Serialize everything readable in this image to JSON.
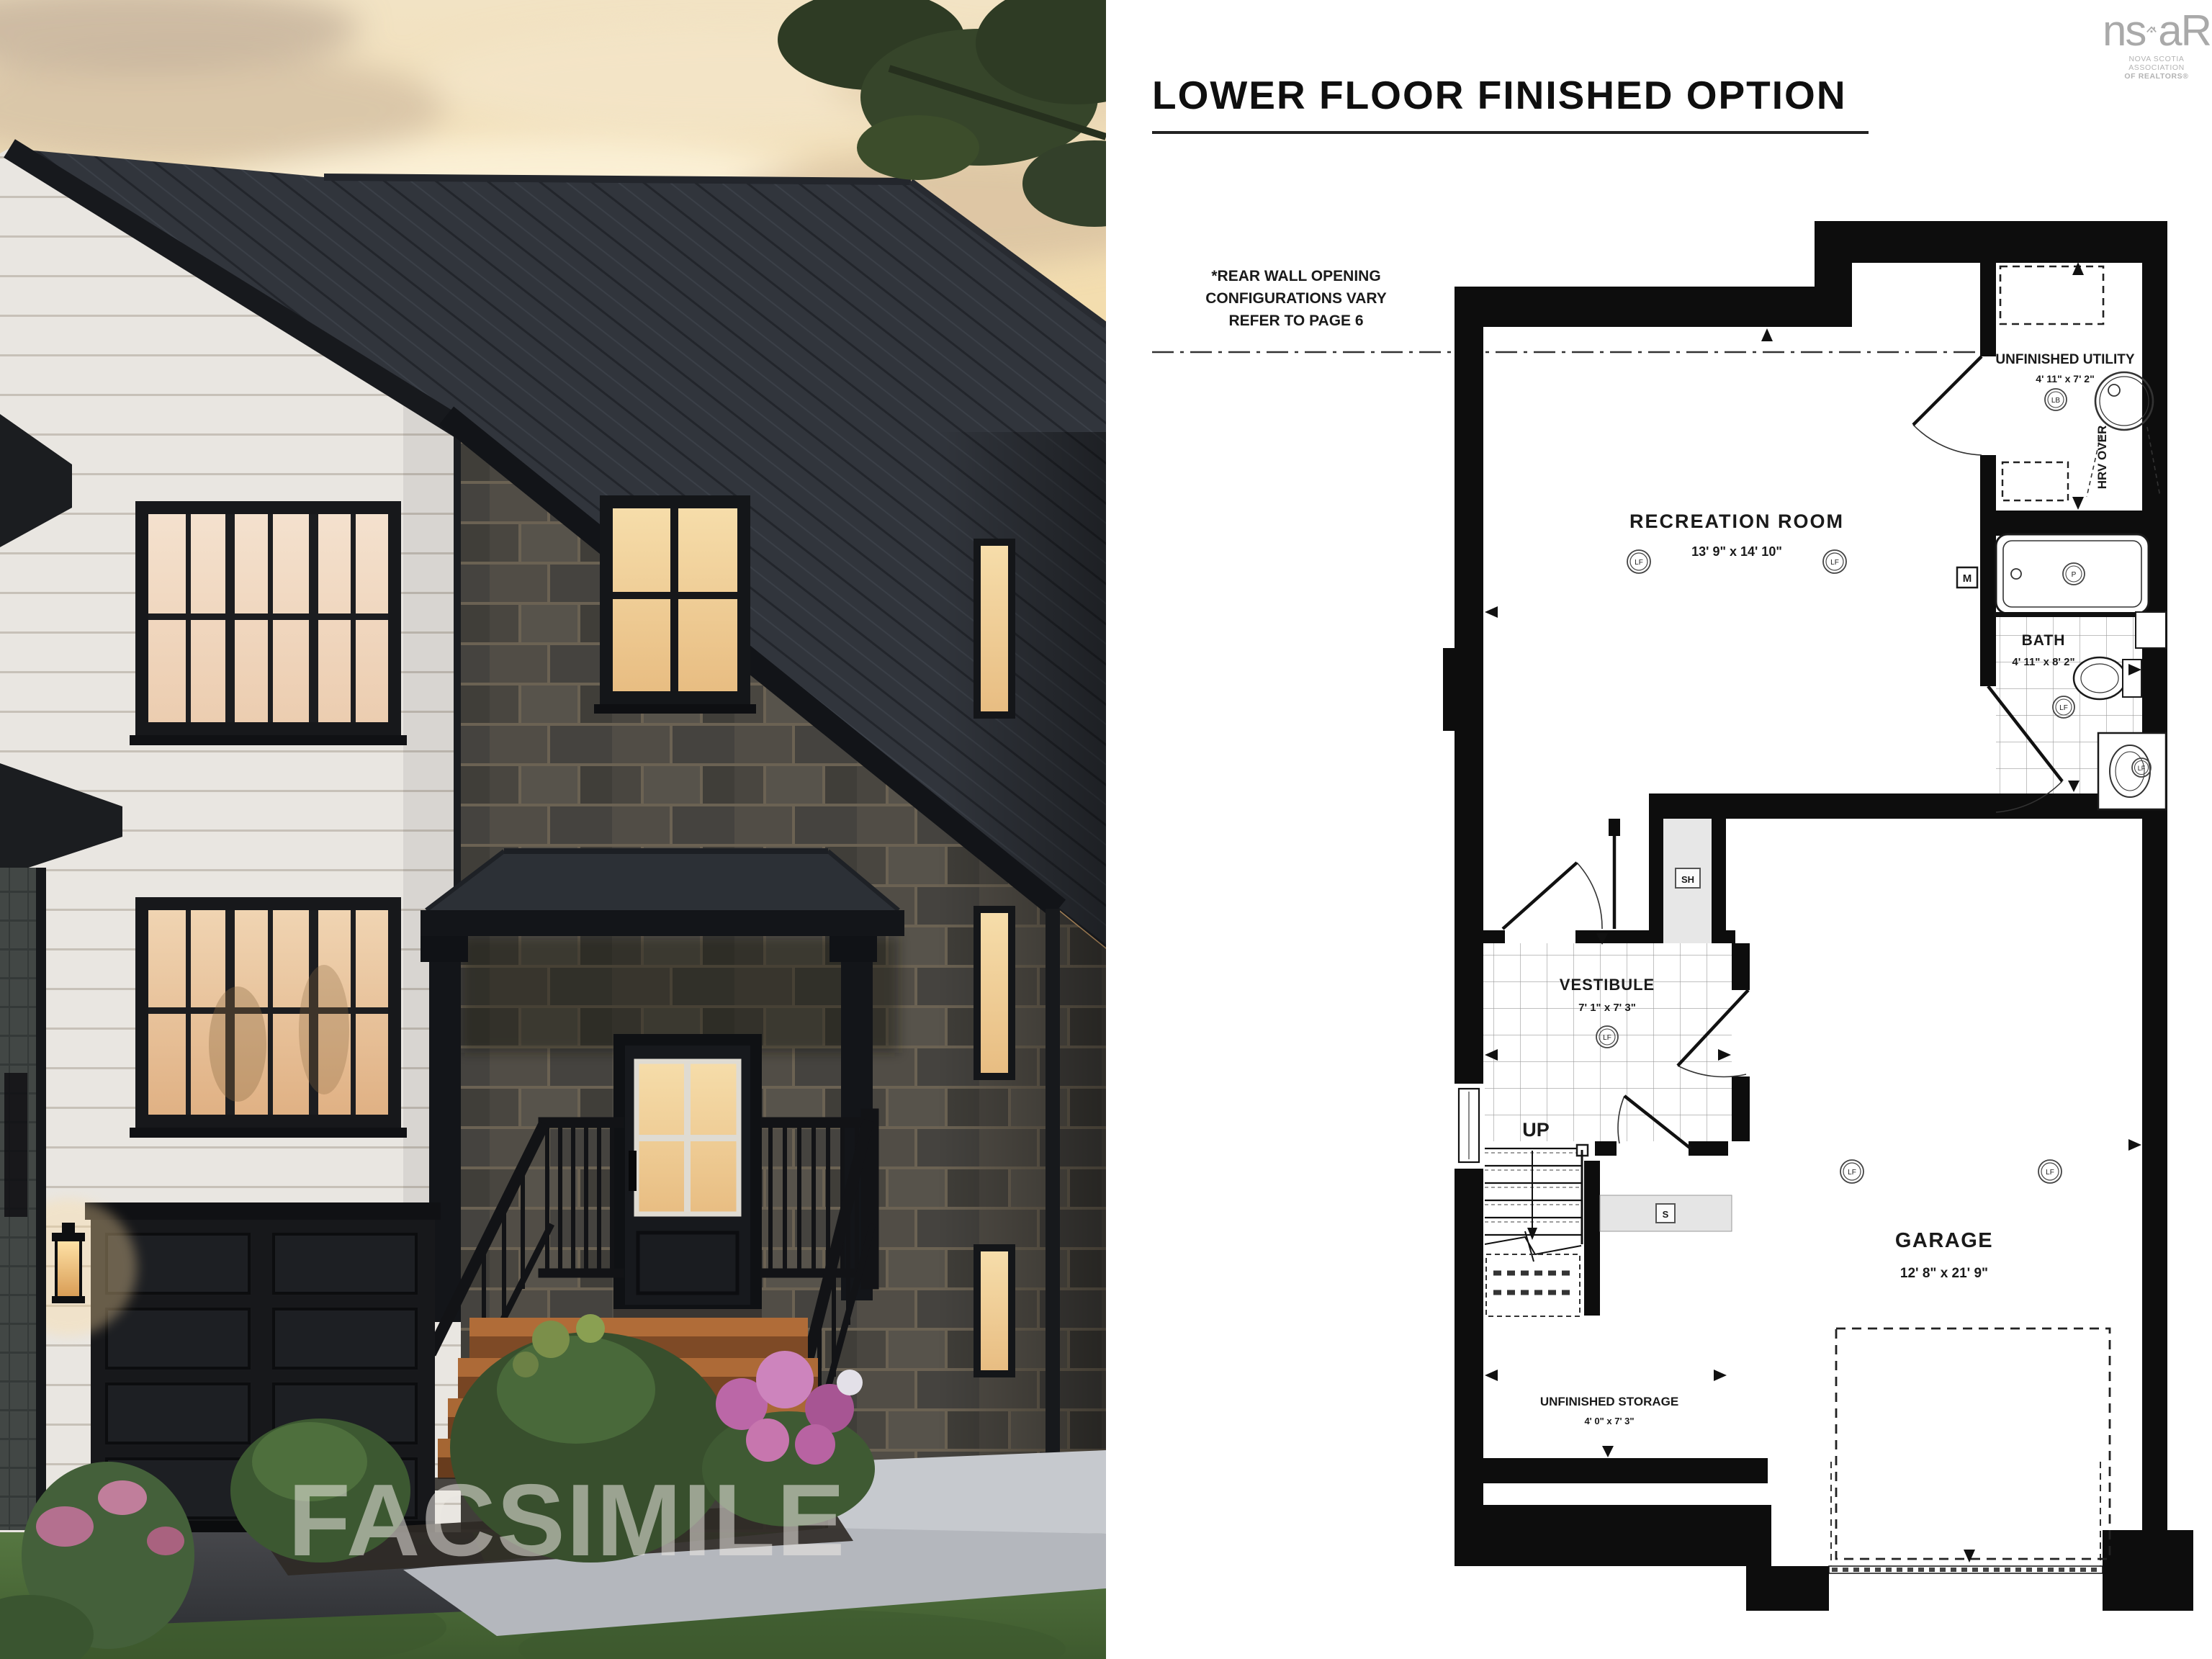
{
  "left_panel": {
    "watermark": "FACSIMILE"
  },
  "right_panel": {
    "title": "LOWER FLOOR FINISHED OPTION",
    "note": {
      "line1": "*REAR WALL OPENING",
      "line2": "CONFIGURATIONS VARY",
      "line3": "REFER TO PAGE 6"
    },
    "logo": {
      "prefix": "ns",
      "suffix": "aR",
      "line1": "NOVA SCOTIA ASSOCIATION",
      "line2": "OF REALTORS®"
    },
    "rooms": {
      "recreation": {
        "name": "RECREATION ROOM",
        "dims": "13' 9\" x 14' 10\""
      },
      "utility": {
        "name": "UNFINISHED UTILITY",
        "dims": "4' 11\" x 7' 2\""
      },
      "bath": {
        "name": "BATH",
        "dims": "4' 11\" x 8' 2\""
      },
      "vestibule": {
        "name": "VESTIBULE",
        "dims": "7' 1\" x 7' 3\""
      },
      "garage": {
        "name": "GARAGE",
        "dims": "12' 8\" x 21' 9\""
      },
      "storage": {
        "name": "UNFINISHED STORAGE",
        "dims": "4' 0\" x 7' 3\""
      }
    },
    "labels": {
      "up": "UP",
      "lf": "LF",
      "lb": "LB",
      "sh": "SH",
      "s": "S",
      "m": "M",
      "p": "P",
      "hrv": "HRV OVER"
    }
  },
  "colors": {
    "plan_line": "#111111",
    "logo_gray": "#a9a9a9",
    "sky_warm": "#eec48a",
    "roof_dark": "#2f333a",
    "wood_step": "#b06c38"
  }
}
